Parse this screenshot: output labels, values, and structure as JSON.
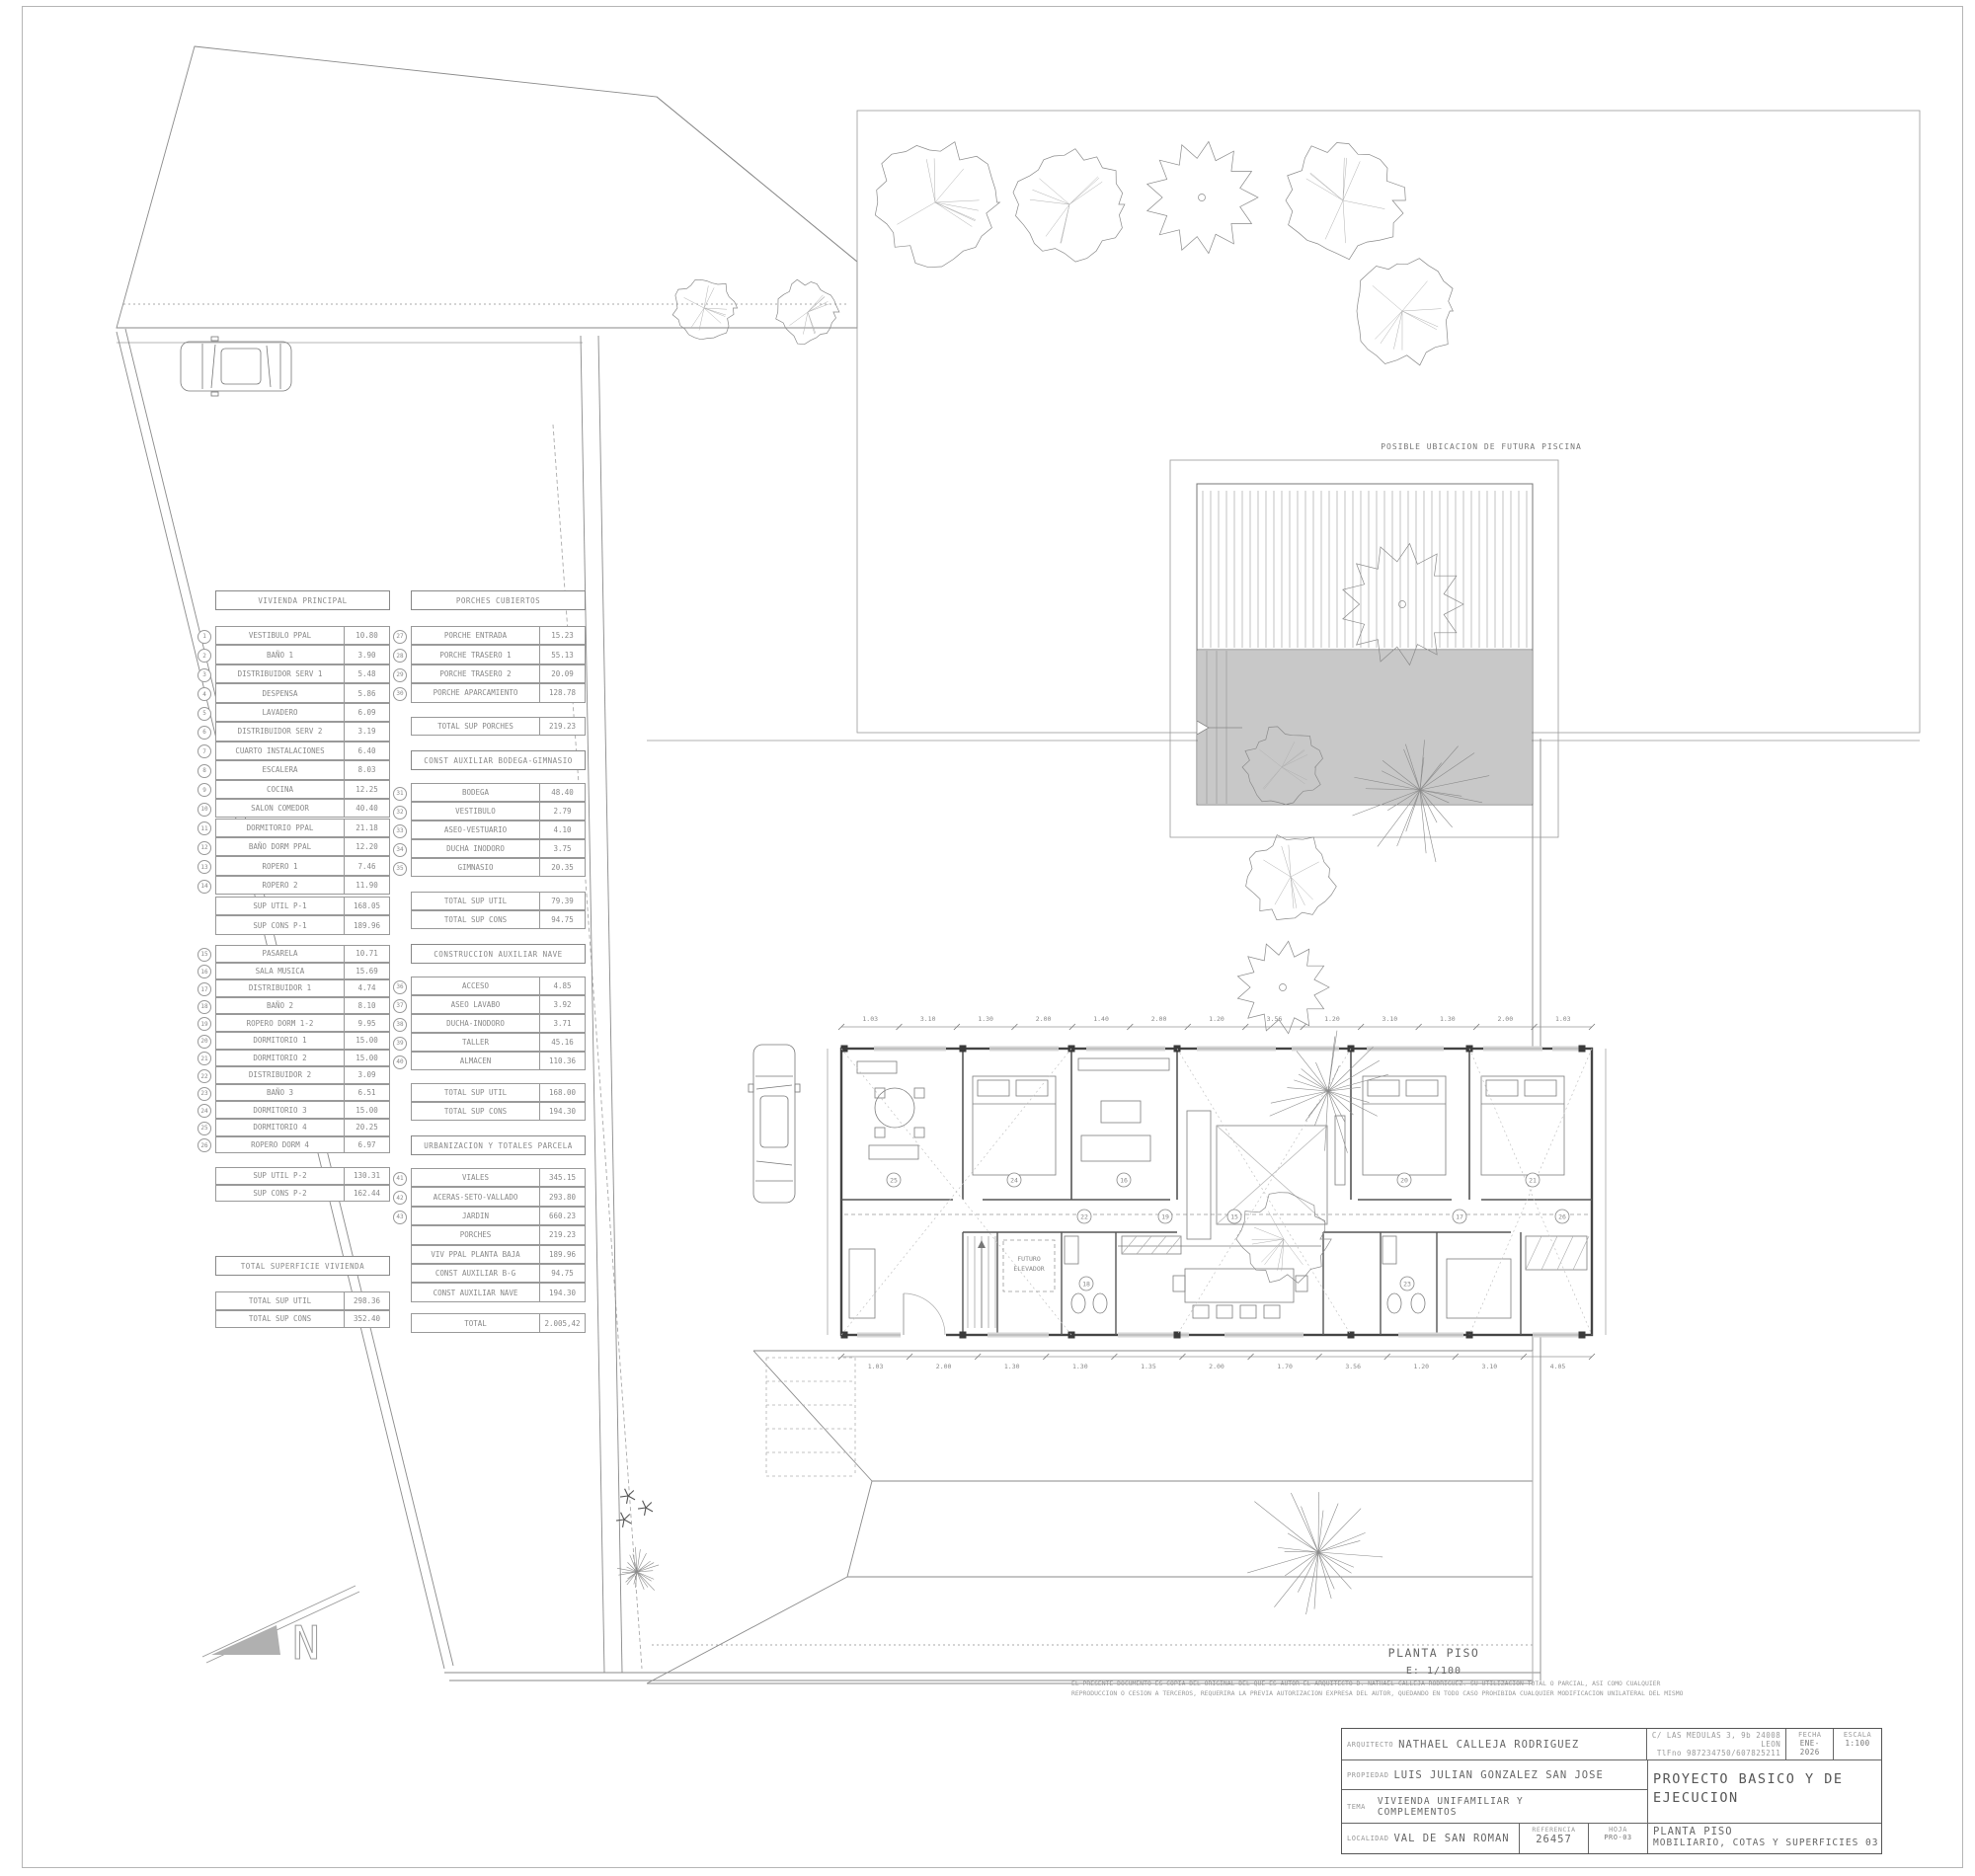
{
  "colors": {
    "line": "#8a8a8a",
    "wall": "#444444",
    "pool_fill": "#c8c8c8",
    "north_fill": "#b0b0b0",
    "text": "#666666"
  },
  "site": {
    "pool_label": "POSIBLE UBICACION DE FUTURA PISCINA"
  },
  "sheet": {
    "plan_label": "PLANTA PISO",
    "plan_scale": "E: 1/100",
    "north_label": "N",
    "disclaimer_line1": "EL PRESENTE DOCUMENTO ES COPIA DEL ORIGINAL DEL QUE ES AUTOR EL ARQUITECTO D. NATHAEL CALLEJA RODRIGUEZ. SU UTILIZACION TOTAL O PARCIAL, ASI COMO CUALQUIER",
    "disclaimer_line2": "REPRODUCCION O CESION A TERCEROS, REQUERIRA LA PREVIA AUTORIZACION EXPRESA DEL AUTOR, QUEDANDO EN TODO CASO PROHIBIDA CUALQUIER MODIFICACION UNILATERAL DEL MISMO",
    "title_block": {
      "arquitecto_label": "ARQUITECTO",
      "arquitecto": "NATHAEL CALLEJA RODRIGUEZ",
      "address_line1": "C/ LAS MEDULAS 3, 9b 24008 LEON",
      "address_line2": "TlFno 987234750/607825211",
      "fecha_label": "FECHA",
      "fecha": "ENE-2026",
      "escala_label": "ESCALA",
      "escala": "1:100",
      "propiedad_label": "PROPIEDAD",
      "propiedad": "LUIS JULIAN GONZALEZ SAN JOSE",
      "proyecto": "PROYECTO BASICO Y DE EJECUCION",
      "tema_label": "TEMA",
      "tema_line1": "VIVIENDA UNIFAMILIAR Y",
      "tema_line2": "COMPLEMENTOS",
      "localidad_label": "LOCALIDAD",
      "localidad": "VAL DE SAN ROMAN",
      "referencia_label": "REFERENCIA",
      "referencia": "26457",
      "hoja_label": "HOJA",
      "hoja": "PRO-03",
      "titulo_line1": "PLANTA PISO",
      "titulo_line2": "MOBILIARIO, COTAS Y SUPERFICIES 03"
    }
  },
  "plan": {
    "elevator_line1": "FUTURO",
    "elevator_line2": "ELEVADOR",
    "room_numbers": [
      "25",
      "24",
      "16",
      "20",
      "21",
      "15",
      "22",
      "17",
      "19",
      "26",
      "18",
      "23"
    ],
    "top_dims": [
      "1.03",
      "3.10",
      "1.30",
      "2.00",
      "1.40",
      "2.00",
      "1.20",
      "3.56",
      "1.20",
      "3.10",
      "1.30",
      "2.00",
      "1.03"
    ],
    "bottom_dims": [
      "1.03",
      "2.00",
      "1.30",
      "1.30",
      "1.35",
      "2.00",
      "1.70",
      "3.56",
      "1.20",
      "3.10",
      "4.05"
    ]
  },
  "tables": {
    "vivienda_principal": {
      "title": "VIVIENDA PRINCIPAL",
      "rows": [
        {
          "num": "1",
          "label": "VESTIBULO PPAL",
          "value": "10.80"
        },
        {
          "num": "2",
          "label": "BAÑO 1",
          "value": "3.90"
        },
        {
          "num": "3",
          "label": "DISTRIBUIDOR SERV 1",
          "value": "5.48"
        },
        {
          "num": "4",
          "label": "DESPENSA",
          "value": "5.86"
        },
        {
          "num": "5",
          "label": "LAVADERO",
          "value": "6.09"
        },
        {
          "num": "6",
          "label": "DISTRIBUIDOR SERV 2",
          "value": "3.19"
        },
        {
          "num": "7",
          "label": "CUARTO INSTALACIONES",
          "value": "6.40"
        },
        {
          "num": "8",
          "label": "ESCALERA",
          "value": "8.03"
        },
        {
          "num": "9",
          "label": "COCINA",
          "value": "12.25"
        },
        {
          "num": "10",
          "label": "SALON COMEDOR",
          "value": "40.40"
        },
        {
          "num": "11",
          "label": "DORMITORIO PPAL",
          "value": "21.18"
        },
        {
          "num": "12",
          "label": "BAÑO DORM PPAL",
          "value": "12.20"
        },
        {
          "num": "13",
          "label": "ROPERO 1",
          "value": "7.46"
        },
        {
          "num": "14",
          "label": "ROPERO 2",
          "value": "11.90"
        }
      ],
      "totals": [
        {
          "label": "SUP UTIL P-1",
          "value": "168.05"
        },
        {
          "label": "SUP CONS P-1",
          "value": "189.96"
        }
      ]
    },
    "planta_piso_rooms": {
      "rows": [
        {
          "num": "15",
          "label": "PASARELA",
          "value": "10.71"
        },
        {
          "num": "16",
          "label": "SALA MUSICA",
          "value": "15.69"
        },
        {
          "num": "17",
          "label": "DISTRIBUIDOR 1",
          "value": "4.74"
        },
        {
          "num": "18",
          "label": "BAÑO 2",
          "value": "8.10"
        },
        {
          "num": "19",
          "label": "ROPERO DORM 1-2",
          "value": "9.95"
        },
        {
          "num": "20",
          "label": "DORMITORIO 1",
          "value": "15.00"
        },
        {
          "num": "21",
          "label": "DORMITORIO 2",
          "value": "15.00"
        },
        {
          "num": "22",
          "label": "DISTRIBUIDOR 2",
          "value": "3.09"
        },
        {
          "num": "23",
          "label": "BAÑO 3",
          "value": "6.51"
        },
        {
          "num": "24",
          "label": "DORMITORIO 3",
          "value": "15.00"
        },
        {
          "num": "25",
          "label": "DORMITORIO 4",
          "value": "20.25"
        },
        {
          "num": "26",
          "label": "ROPERO DORM 4",
          "value": "6.97"
        }
      ],
      "totals": [
        {
          "label": "SUP UTIL P-2",
          "value": "130.31"
        },
        {
          "label": "SUP CONS P-2",
          "value": "162.44"
        }
      ]
    },
    "total_vivienda": {
      "title": "TOTAL SUPERFICIE VIVIENDA",
      "rows": [],
      "totals": [
        {
          "label": "TOTAL SUP UTIL",
          "value": "298.36"
        },
        {
          "label": "TOTAL SUP CONS",
          "value": "352.40"
        }
      ]
    },
    "porches": {
      "title": "PORCHES CUBIERTOS",
      "rows": [
        {
          "num": "27",
          "label": "PORCHE ENTRADA",
          "value": "15.23"
        },
        {
          "num": "28",
          "label": "PORCHE TRASERO 1",
          "value": "55.13"
        },
        {
          "num": "29",
          "label": "PORCHE TRASERO 2",
          "value": "20.09"
        },
        {
          "num": "30",
          "label": "PORCHE APARCAMIENTO",
          "value": "128.78"
        }
      ],
      "totals": [
        {
          "label": "TOTAL SUP PORCHES",
          "value": "219.23"
        }
      ]
    },
    "bodega_gimnasio": {
      "title": "CONST AUXILIAR BODEGA-GIMNASIO",
      "rows": [
        {
          "num": "31",
          "label": "BODEGA",
          "value": "48.40"
        },
        {
          "num": "32",
          "label": "VESTIBULO",
          "value": "2.79"
        },
        {
          "num": "33",
          "label": "ASEO-VESTUARIO",
          "value": "4.10"
        },
        {
          "num": "34",
          "label": "DUCHA INODORO",
          "value": "3.75"
        },
        {
          "num": "35",
          "label": "GIMNASIO",
          "value": "20.35"
        }
      ],
      "totals": [
        {
          "label": "TOTAL SUP UTIL",
          "value": "79.39"
        },
        {
          "label": "TOTAL SUP CONS",
          "value": "94.75"
        }
      ]
    },
    "nave": {
      "title": "CONSTRUCCION AUXILIAR NAVE",
      "rows": [
        {
          "num": "36",
          "label": "ACCESO",
          "value": "4.85"
        },
        {
          "num": "37",
          "label": "ASEO LAVABO",
          "value": "3.92"
        },
        {
          "num": "38",
          "label": "DUCHA-INODORO",
          "value": "3.71"
        },
        {
          "num": "39",
          "label": "TALLER",
          "value": "45.16"
        },
        {
          "num": "40",
          "label": "ALMACEN",
          "value": "110.36"
        }
      ],
      "totals": [
        {
          "label": "TOTAL SUP UTIL",
          "value": "168.00"
        },
        {
          "label": "TOTAL SUP CONS",
          "value": "194.30"
        }
      ]
    },
    "urbanizacion": {
      "title": "URBANIZACION Y TOTALES PARCELA",
      "rows": [
        {
          "num": "41",
          "label": "VIALES",
          "value": "345.15"
        },
        {
          "num": "42",
          "label": "ACERAS-SETO-VALLADO",
          "value": "293.80"
        },
        {
          "num": "43",
          "label": "JARDIN",
          "value": "660.23"
        },
        {
          "label": "PORCHES",
          "value": "219.23"
        },
        {
          "label": "VIV PPAL PLANTA BAJA",
          "value": "189.96"
        },
        {
          "label": "CONST AUXILIAR B-G",
          "value": "94.75"
        },
        {
          "label": "CONST AUXILIAR NAVE",
          "value": "194.30"
        }
      ],
      "totals": [
        {
          "label": "TOTAL",
          "value": "2.005,42"
        }
      ]
    }
  }
}
